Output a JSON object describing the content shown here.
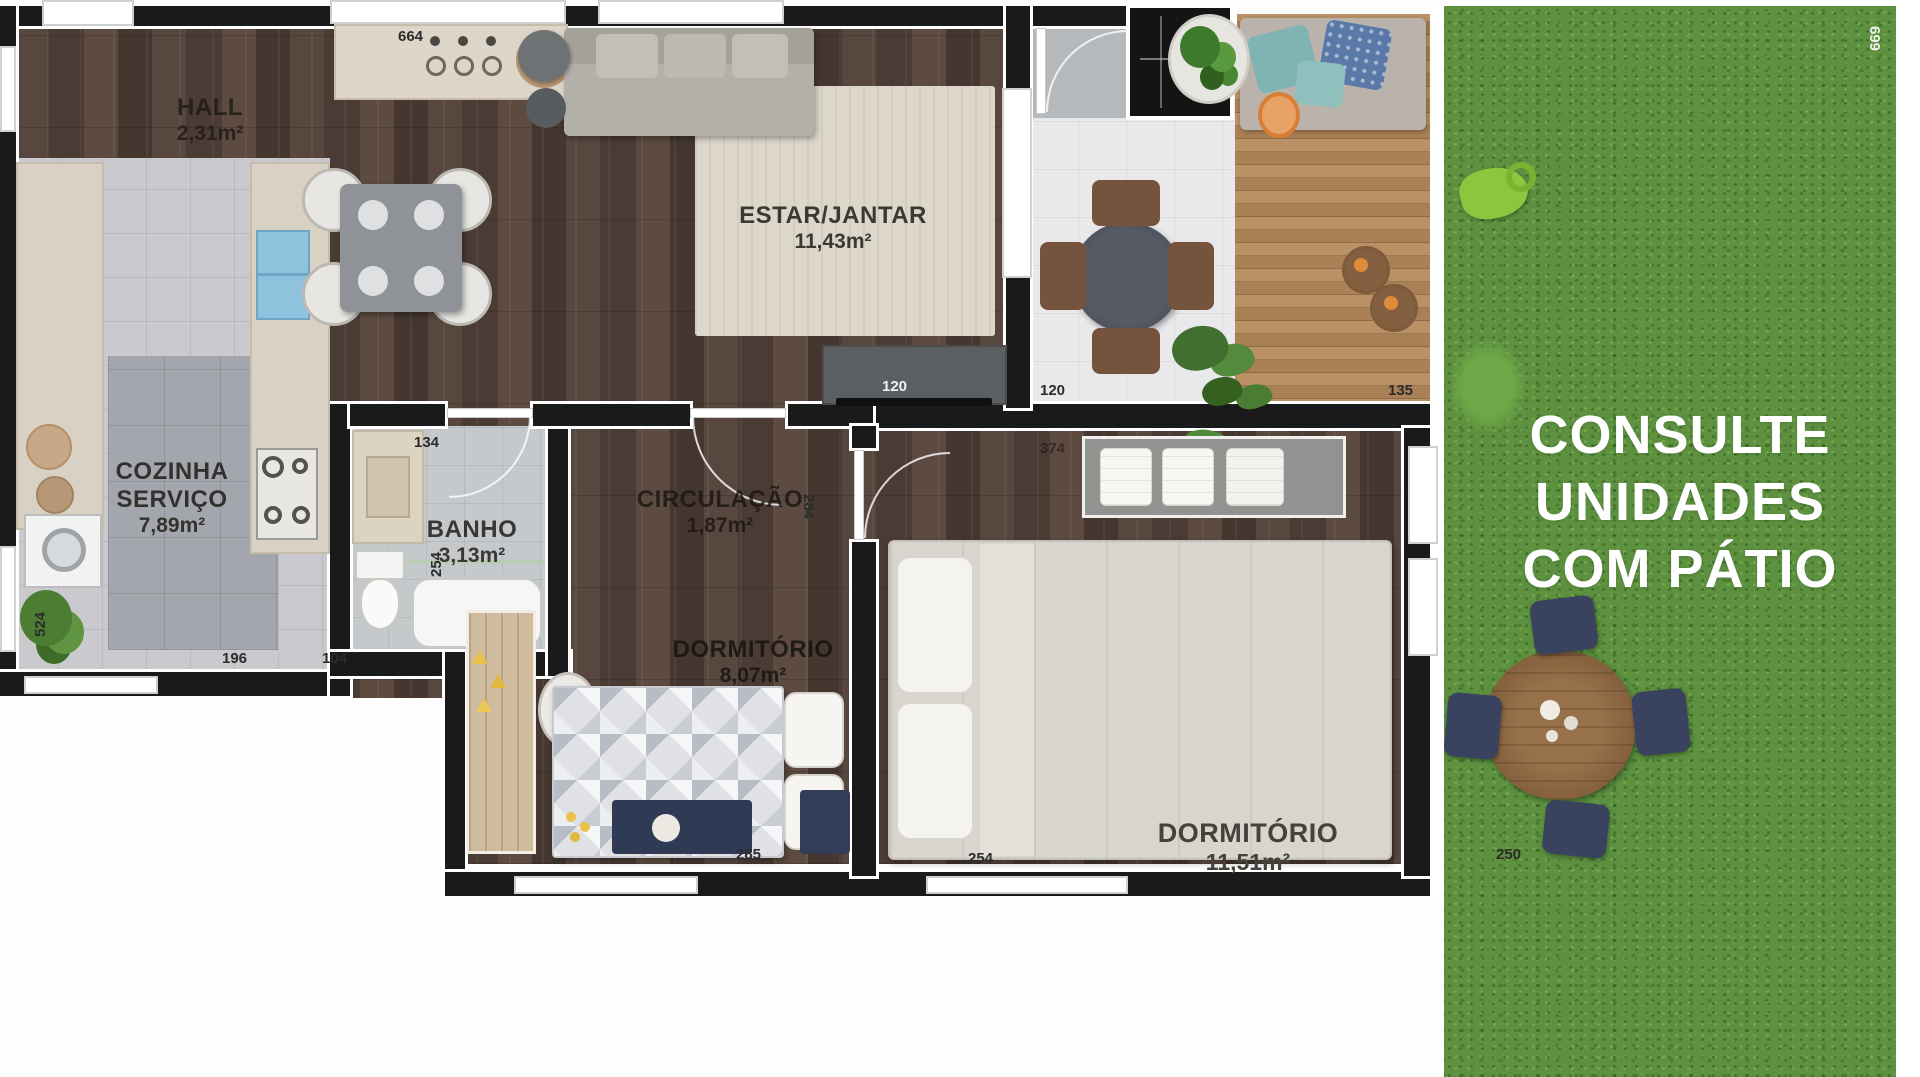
{
  "brand": {
    "lines": [
      "CONSULTE",
      "UNIDADES",
      "COM PÁTIO"
    ]
  },
  "rooms": {
    "hall": {
      "name": "HALL",
      "area": "2,31m²"
    },
    "kitchen": {
      "name_line1": "COZINHA",
      "name_line2": "SERVIÇO",
      "area": "7,89m²"
    },
    "bath": {
      "name": "BANHO",
      "area": "3,13m²"
    },
    "circulation": {
      "name": "CIRCULAÇÃO",
      "area": "1,87m²"
    },
    "living": {
      "name": "ESTAR/JANTAR",
      "area": "11,43m²"
    },
    "bedroom1": {
      "name": "DORMITÓRIO",
      "area": "8,07m²"
    },
    "bedroom2": {
      "name": "DORMITÓRIO",
      "area": "11,51m²"
    }
  },
  "dims": {
    "counter_top": "664",
    "shaft": "254",
    "grass_right": "699",
    "tv_console": "120",
    "patio_floor": "120",
    "deck_edge": "135",
    "bath_door": "134",
    "dorm2_door": "374",
    "service_wall": "524",
    "kitchen_bottom": "196",
    "bath_bottom": "104",
    "bath_wall": "254",
    "dorm1_wall": "284",
    "dorm1_bottom": "285",
    "dorm2_bottom": "254",
    "patio_grass": "250"
  },
  "colors": {
    "wall": "#1a1a1a",
    "wood_floor": "#51413a",
    "grass": "#5d9140",
    "deck": "#b0875c",
    "navy_chair": "#39425e",
    "accent_text": "#ffffff"
  }
}
